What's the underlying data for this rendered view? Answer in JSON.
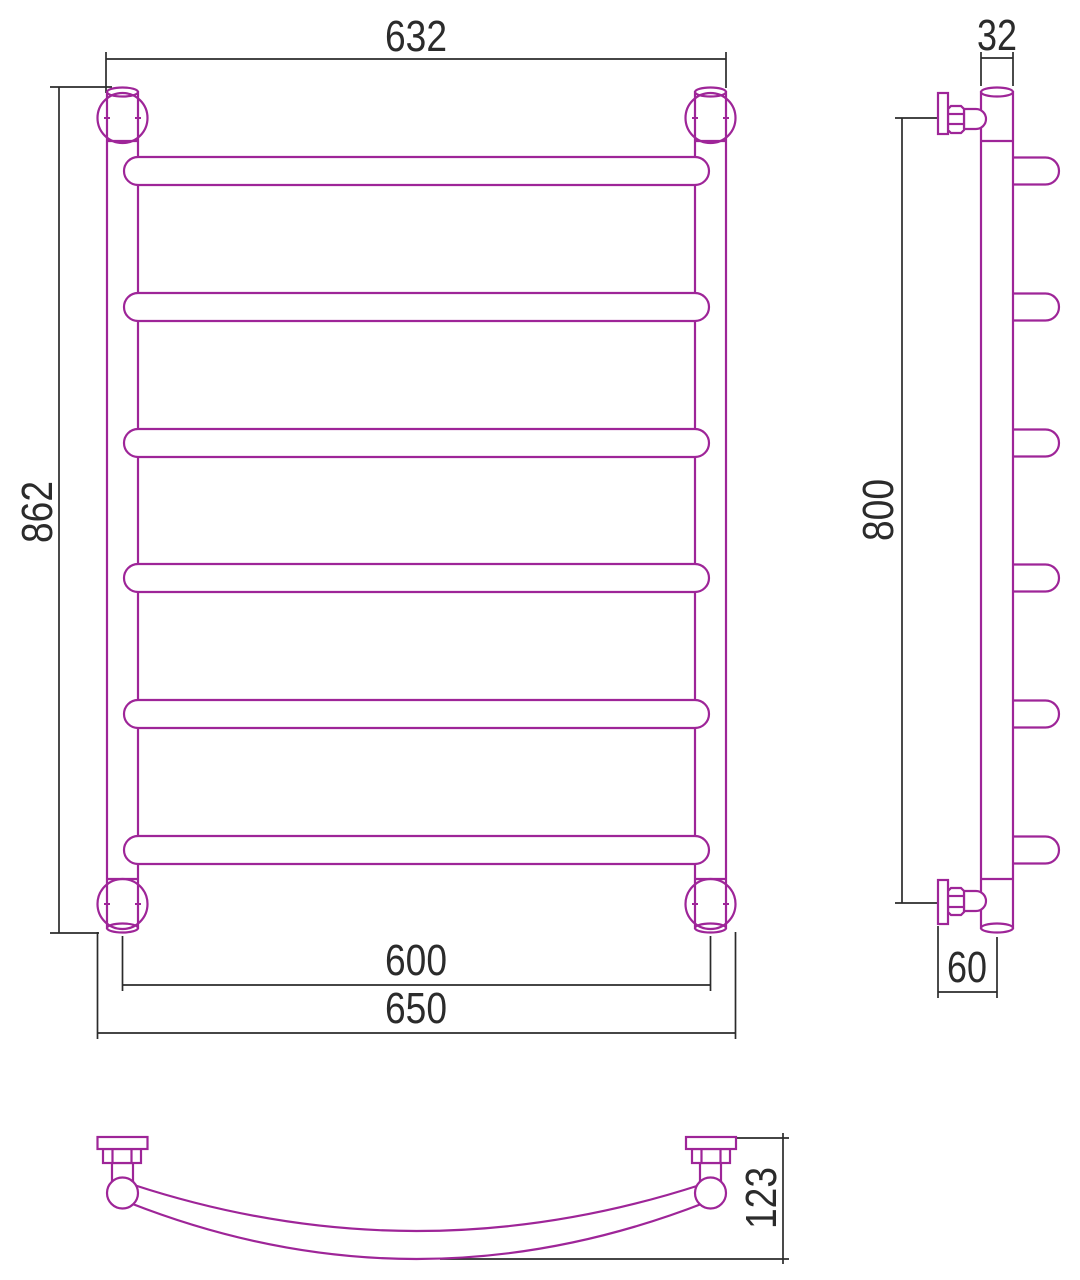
{
  "drawing": {
    "kind": "technical-dimension-drawing",
    "subject": "ladder towel rail with curved bars, three orthographic views",
    "background_color": "#ffffff",
    "product_line_color": "#9e2598",
    "dimension_line_color": "#2b2b2b",
    "views": {
      "front": {
        "name": "front view",
        "rail_count": 6,
        "dims": {
          "top_width": "632",
          "overall_height": "862",
          "axis_width": "600",
          "overall_width": "650"
        }
      },
      "side": {
        "name": "side view",
        "hook_count": 6,
        "dims": {
          "tube_diameter": "32",
          "bracket_span": "800",
          "wall_offset": "60"
        }
      },
      "top": {
        "name": "top view",
        "dims": {
          "depth": "123"
        }
      }
    }
  }
}
